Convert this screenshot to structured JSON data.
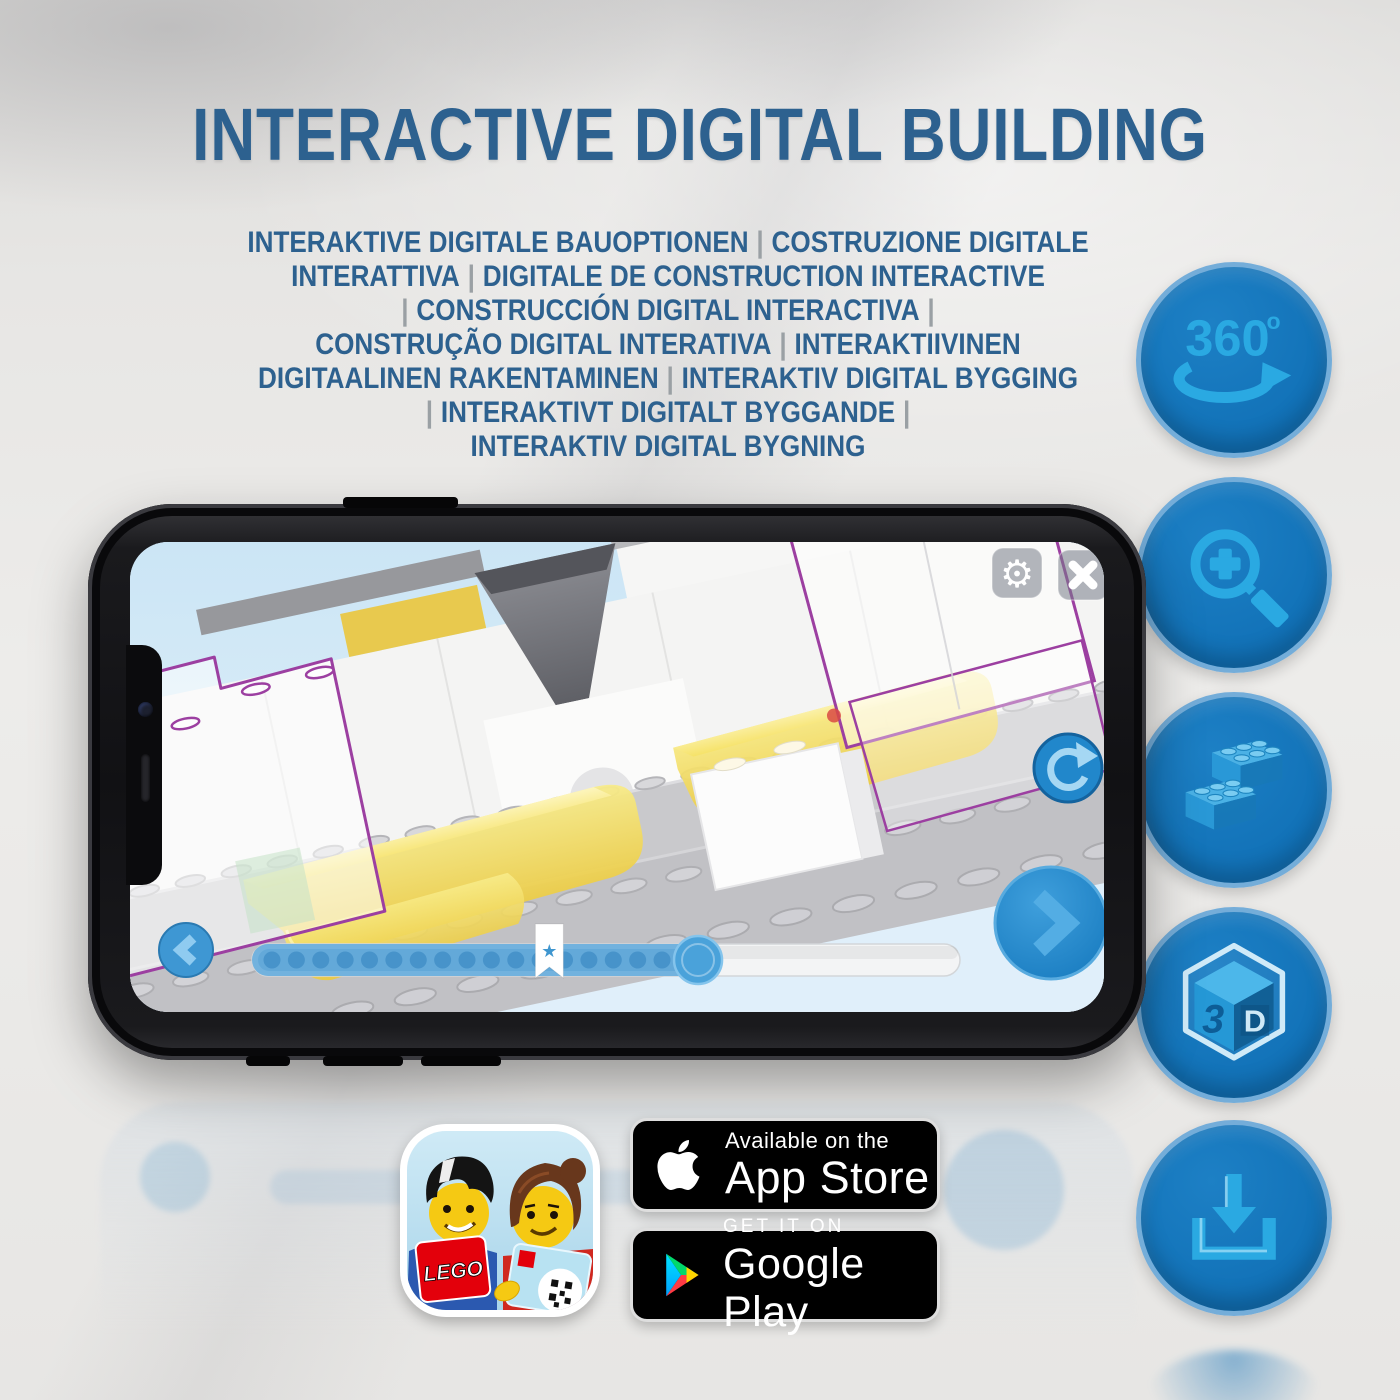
{
  "page": {
    "title": "INTERACTIVE DIGITAL BUILDING"
  },
  "subtitle": {
    "lines": [
      "INTERAKTIVE DIGITALE BAUOPTIONEN | COSTRUZIONE DIGITALE",
      "INTERATTIVA | DIGITALE DE CONSTRUCTION INTERACTIVE",
      "| CONSTRUCCIÓN DIGITAL INTERACTIVA |",
      "CONSTRUÇÃO DIGITAL INTERATIVA | INTERAKTIIVINEN",
      "DIGITAALINEN RAKENTAMINEN | INTERAKTIV DIGITAL BYGGING",
      "| INTERAKTIVT DIGITALT BYGGANDE |",
      "INTERAKTIV DIGITAL BYGNING"
    ]
  },
  "feature_icons": [
    {
      "id": "360-rotation",
      "label": "360",
      "superscript": "o"
    },
    {
      "id": "zoom-in"
    },
    {
      "id": "brick-building"
    },
    {
      "id": "3d-view",
      "face_left": "3",
      "face_right": "D"
    },
    {
      "id": "download"
    }
  ],
  "phone_app": {
    "progress": {
      "percent": 63,
      "step_dots": 17,
      "bookmark_percent": 42
    }
  },
  "store_badges": {
    "app_store": {
      "tagline": "Available on the",
      "name": "App Store"
    },
    "google_play": {
      "tagline": "GET IT ON",
      "name": "Google Play"
    }
  },
  "app_icon": {
    "brand": "LEGO"
  },
  "colors": {
    "title_text": "#2d618f",
    "separator_grey": "#9aa0a4",
    "circle_fill": "#1171b7",
    "circle_border": "#74add9",
    "icon_glyph": "#2aa9e2",
    "slider_blue": "#72b2de",
    "ghost_outline": "#9c3fa1",
    "yellow_brick": "#f0d84e",
    "screen_sky": "#d5eaf7",
    "badge_background": "#000000"
  }
}
